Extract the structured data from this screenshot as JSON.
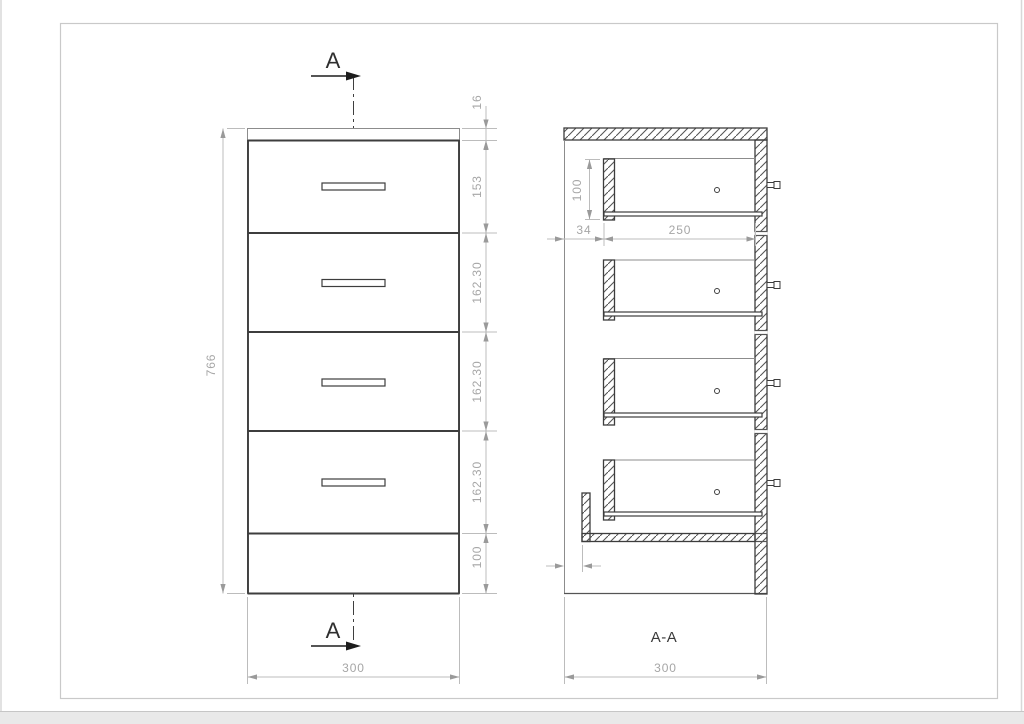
{
  "drawing": {
    "type": "cabinet-technical-drawing",
    "front_view": {
      "section_arrow_top_label": "A",
      "section_arrow_bottom_label": "A",
      "dim_overall_height": "766",
      "dim_top_panel": "16",
      "dim_rows": [
        "153",
        "162.30",
        "162.30",
        "162.30",
        "100"
      ],
      "dim_width": "300"
    },
    "section_view": {
      "title": "A-A",
      "dim_drawer_back_height": "100",
      "dim_back_offset": "34",
      "dim_drawer_depth": "250",
      "dim_bottom_gap": "0",
      "dim_width": "300"
    },
    "colors": {
      "outline": "#3d3d3d",
      "dimension": "#a6a6a6",
      "section_marks": "#1d1d1d",
      "frame": "#c9c9c9",
      "page_edge_band": "#e9e9e9"
    }
  }
}
